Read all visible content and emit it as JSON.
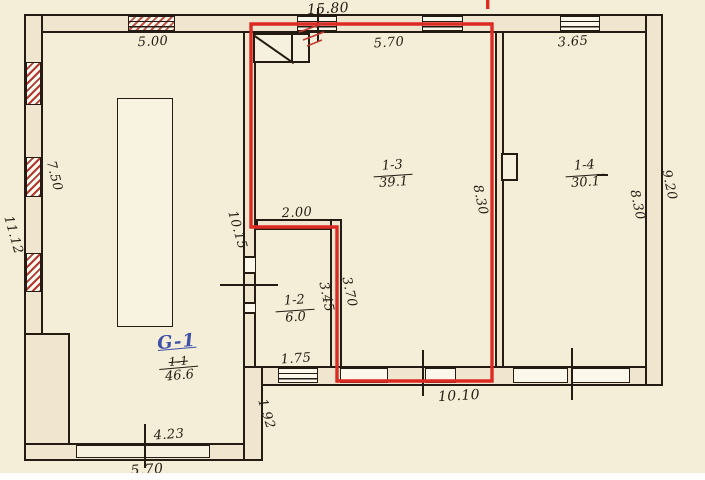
{
  "drawing": {
    "type": "scanned building floor plan",
    "highlighted_room_label": "1-3",
    "colors": {
      "ink": "#241c12",
      "highlight_red": "#dc2a22",
      "hatch_red": "#b2372f",
      "blue_ink": "#3f51a8",
      "paper": "#f4edd8",
      "wall_fill": "#f0e6d0"
    }
  },
  "rooms": {
    "g1": {
      "new_label": "G-1",
      "old_label": "1-1",
      "area": "46.6"
    },
    "r12": {
      "label": "1-2",
      "area": "6.0"
    },
    "r13": {
      "label": "1-3",
      "area": "39.1"
    },
    "r14": {
      "label": "1-4",
      "area": "30.1"
    }
  },
  "dims": {
    "top_total": "15.80",
    "g1_top": "5.00",
    "r13_top": "5.70",
    "r14_top": "3.65",
    "g1_left": "7.50",
    "outer_left": "11.12",
    "g1_right": "10.15",
    "r12_top": "2.00",
    "r12_inner": "3.45",
    "r12_outer": "3.70",
    "r12_bottom": "1.75",
    "r13_right": "8.30",
    "r14_right": "8.30",
    "outer_right": "9.20",
    "bottom_mid": "10.10",
    "g1_bottom": "4.23",
    "g1_bottom_outer": "5.70",
    "step": "1.92"
  }
}
